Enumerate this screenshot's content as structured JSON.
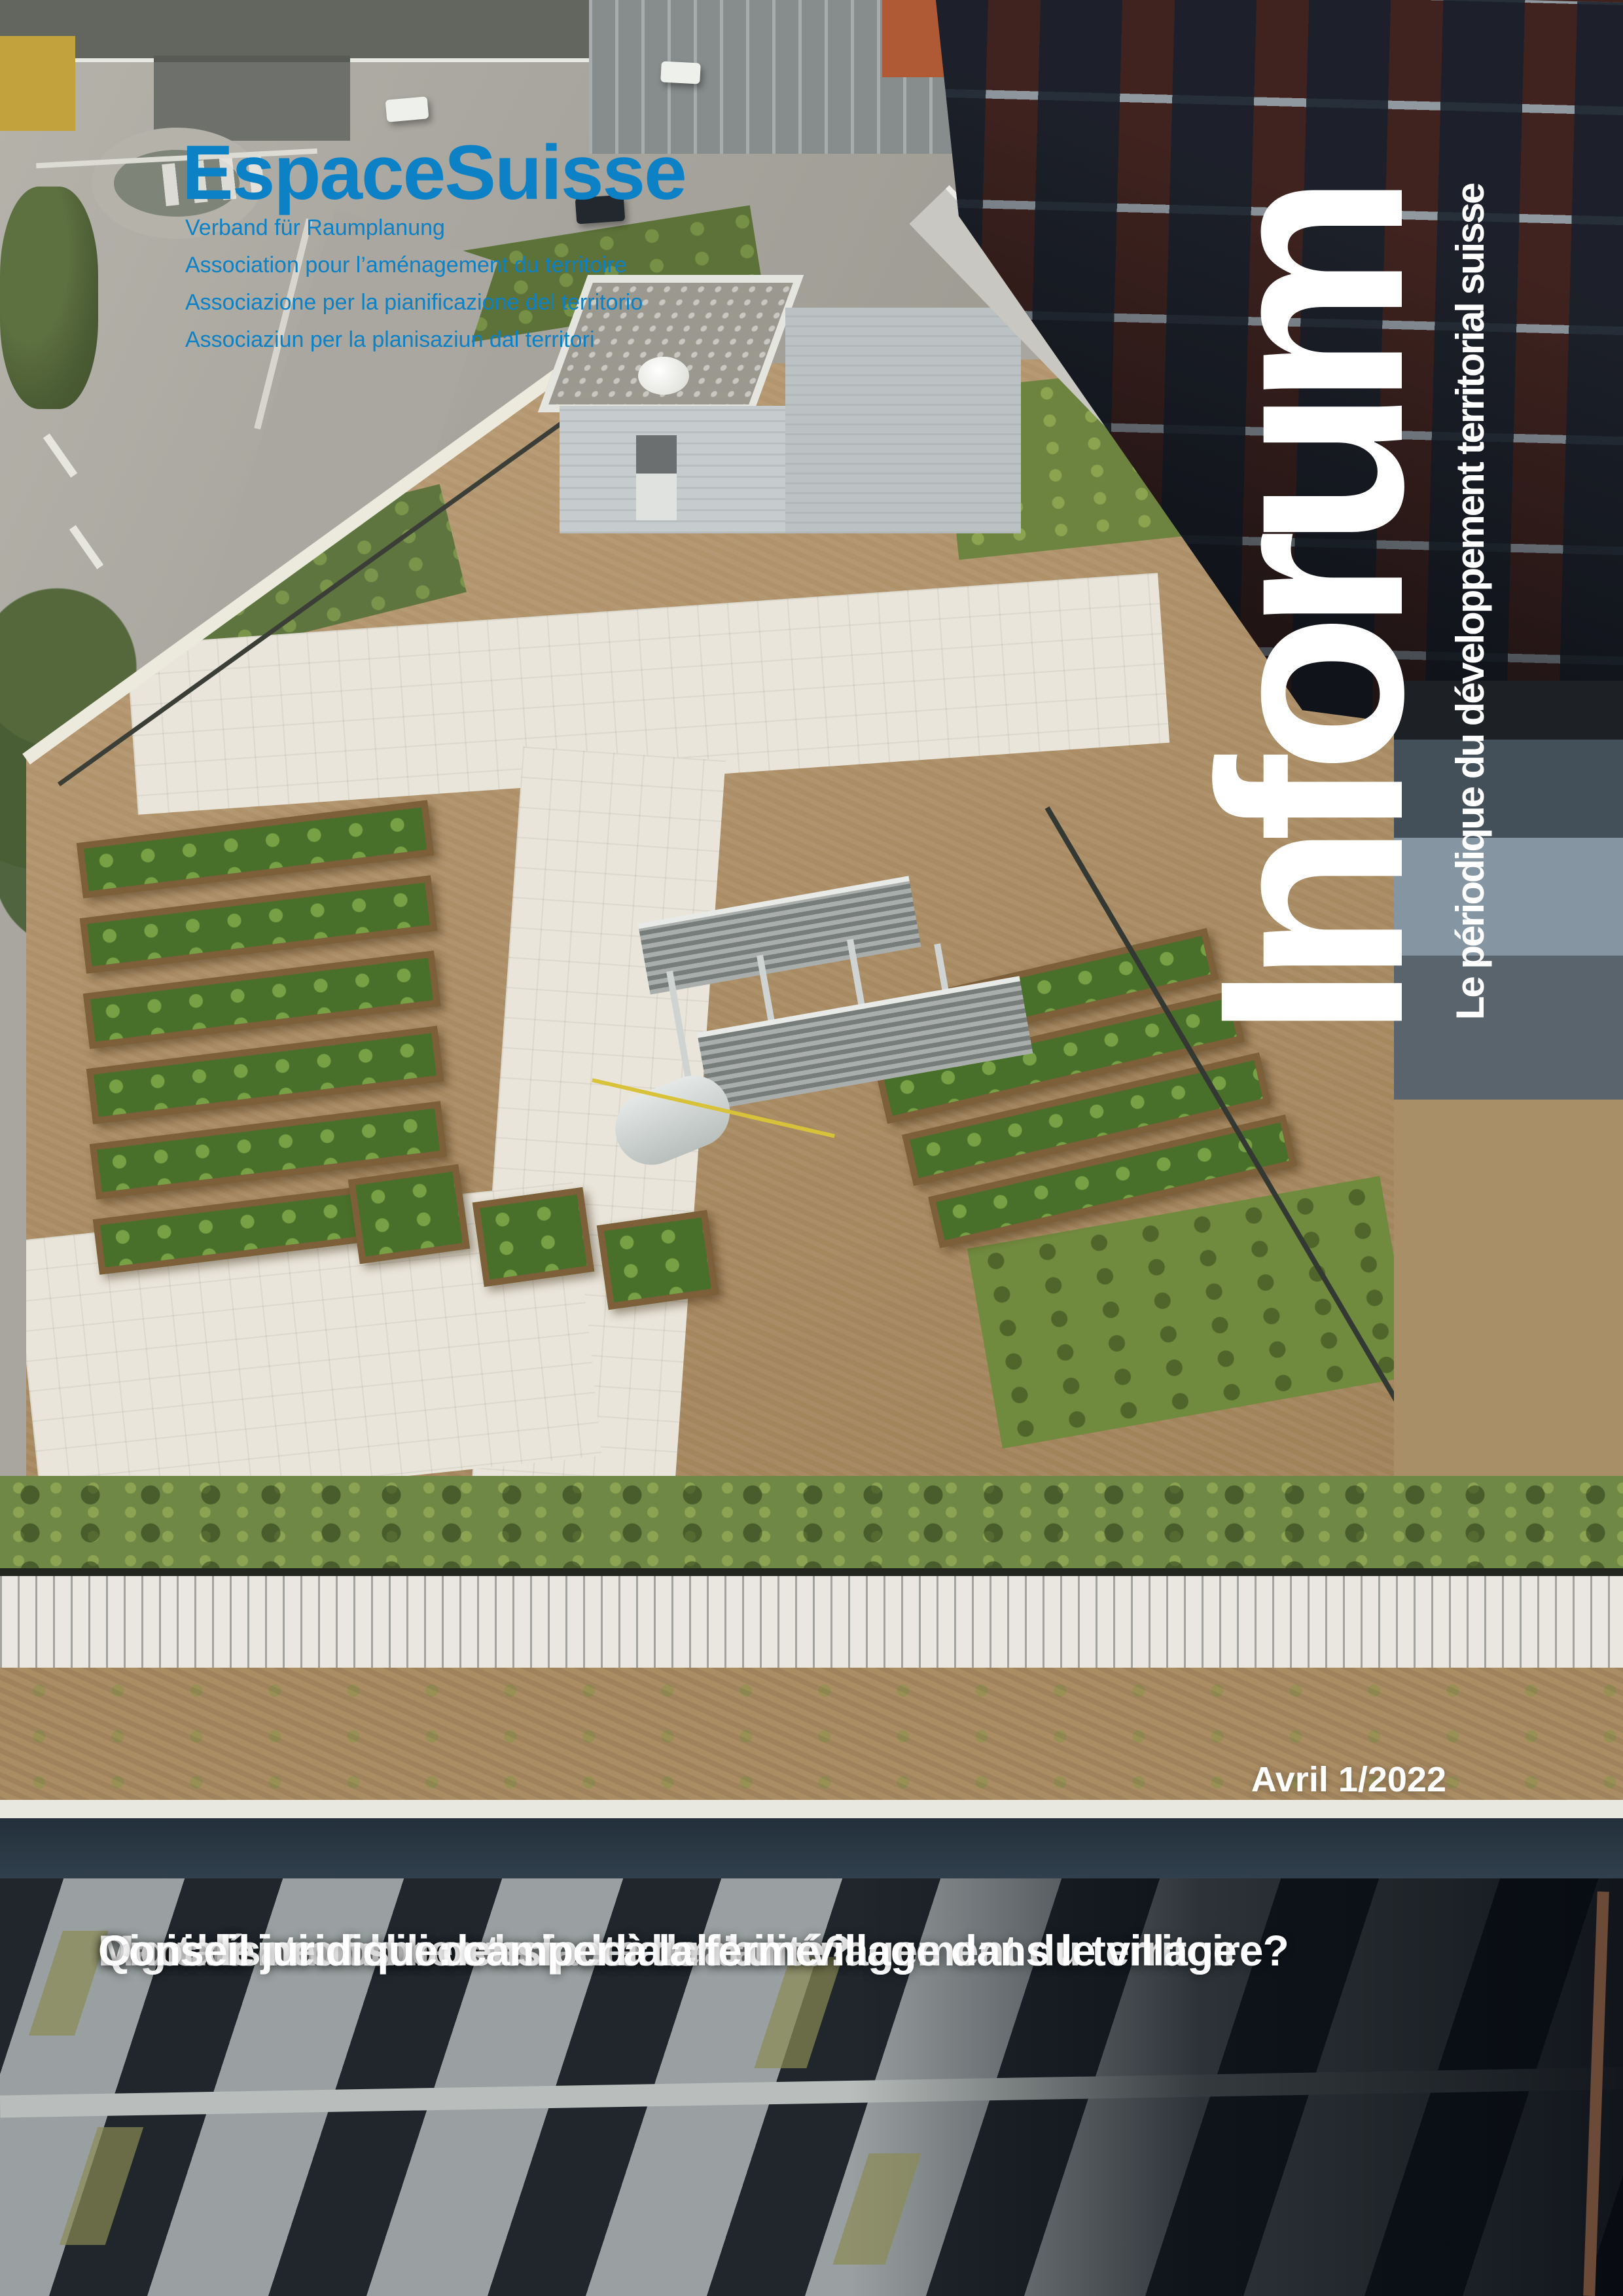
{
  "publisher": {
    "logo": "EspaceSuisse",
    "taglines": [
      "Verband für Raumplanung",
      "Association pour l’aménagement du territoire",
      "Associazione per la pianificazione del territorio",
      "Associaziun per la planisaziun dal territori"
    ]
  },
  "masthead": {
    "title": "Inforum",
    "subtitle": "Le périodique du développement territorial suisse",
    "issue": "Avril 1/2022"
  },
  "headlines": [
    "Marché immobilier: la faute de l’aménagement du territoire?",
    "Digitalisation: boosteur de durabilité?",
    "Quoi de neuf sur densipedia.ch: un village dans le village",
    "Conseil juridique: camper à la ferme"
  ],
  "colors": {
    "brand_blue": "#0c81c6",
    "title_white": "#ffffff"
  }
}
